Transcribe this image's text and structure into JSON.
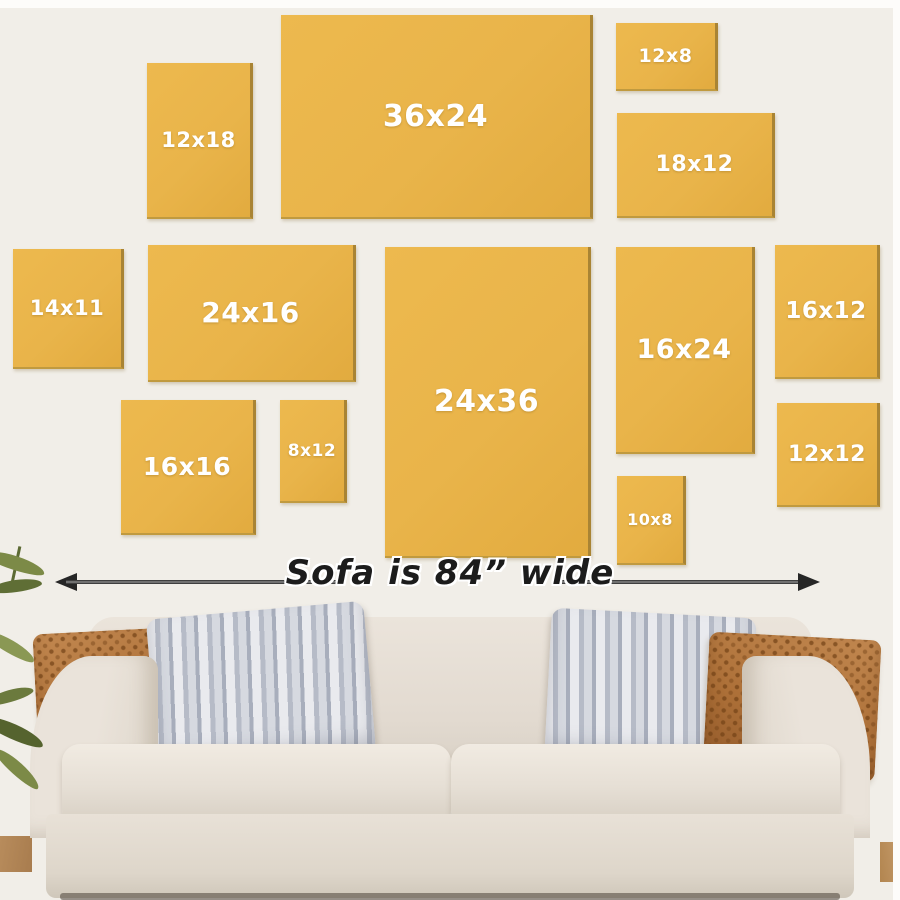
{
  "scene": {
    "description": "Wall art canvas size guide above a sofa",
    "colors": {
      "wall": "#f1eee8",
      "frame": "#e9b44a",
      "frame_edge": "#a98434",
      "frame_label": "#ffffff",
      "arrow": "#262626",
      "caption_text": "#1c1c1c",
      "sofa_body": "#e7e0d6",
      "pillow_rust": "#ad7038",
      "pillow_stripe_light": "#e9eaee",
      "pillow_stripe_dark": "#a8aebc",
      "plant_green": "#6b7a3d",
      "floor_wood": "#b88c5c"
    }
  },
  "frames": [
    {
      "label": "12x18"
    },
    {
      "label": "36x24"
    },
    {
      "label": "12x8"
    },
    {
      "label": "18x12"
    },
    {
      "label": "14x11"
    },
    {
      "label": "24x16"
    },
    {
      "label": "16x16"
    },
    {
      "label": "8x12"
    },
    {
      "label": "24x36"
    },
    {
      "label": "16x24"
    },
    {
      "label": "10x8"
    },
    {
      "label": "16x12"
    },
    {
      "label": "12x12"
    }
  ],
  "sofa": {
    "caption": "Sofa is 84” wide",
    "width_value": "84”"
  }
}
